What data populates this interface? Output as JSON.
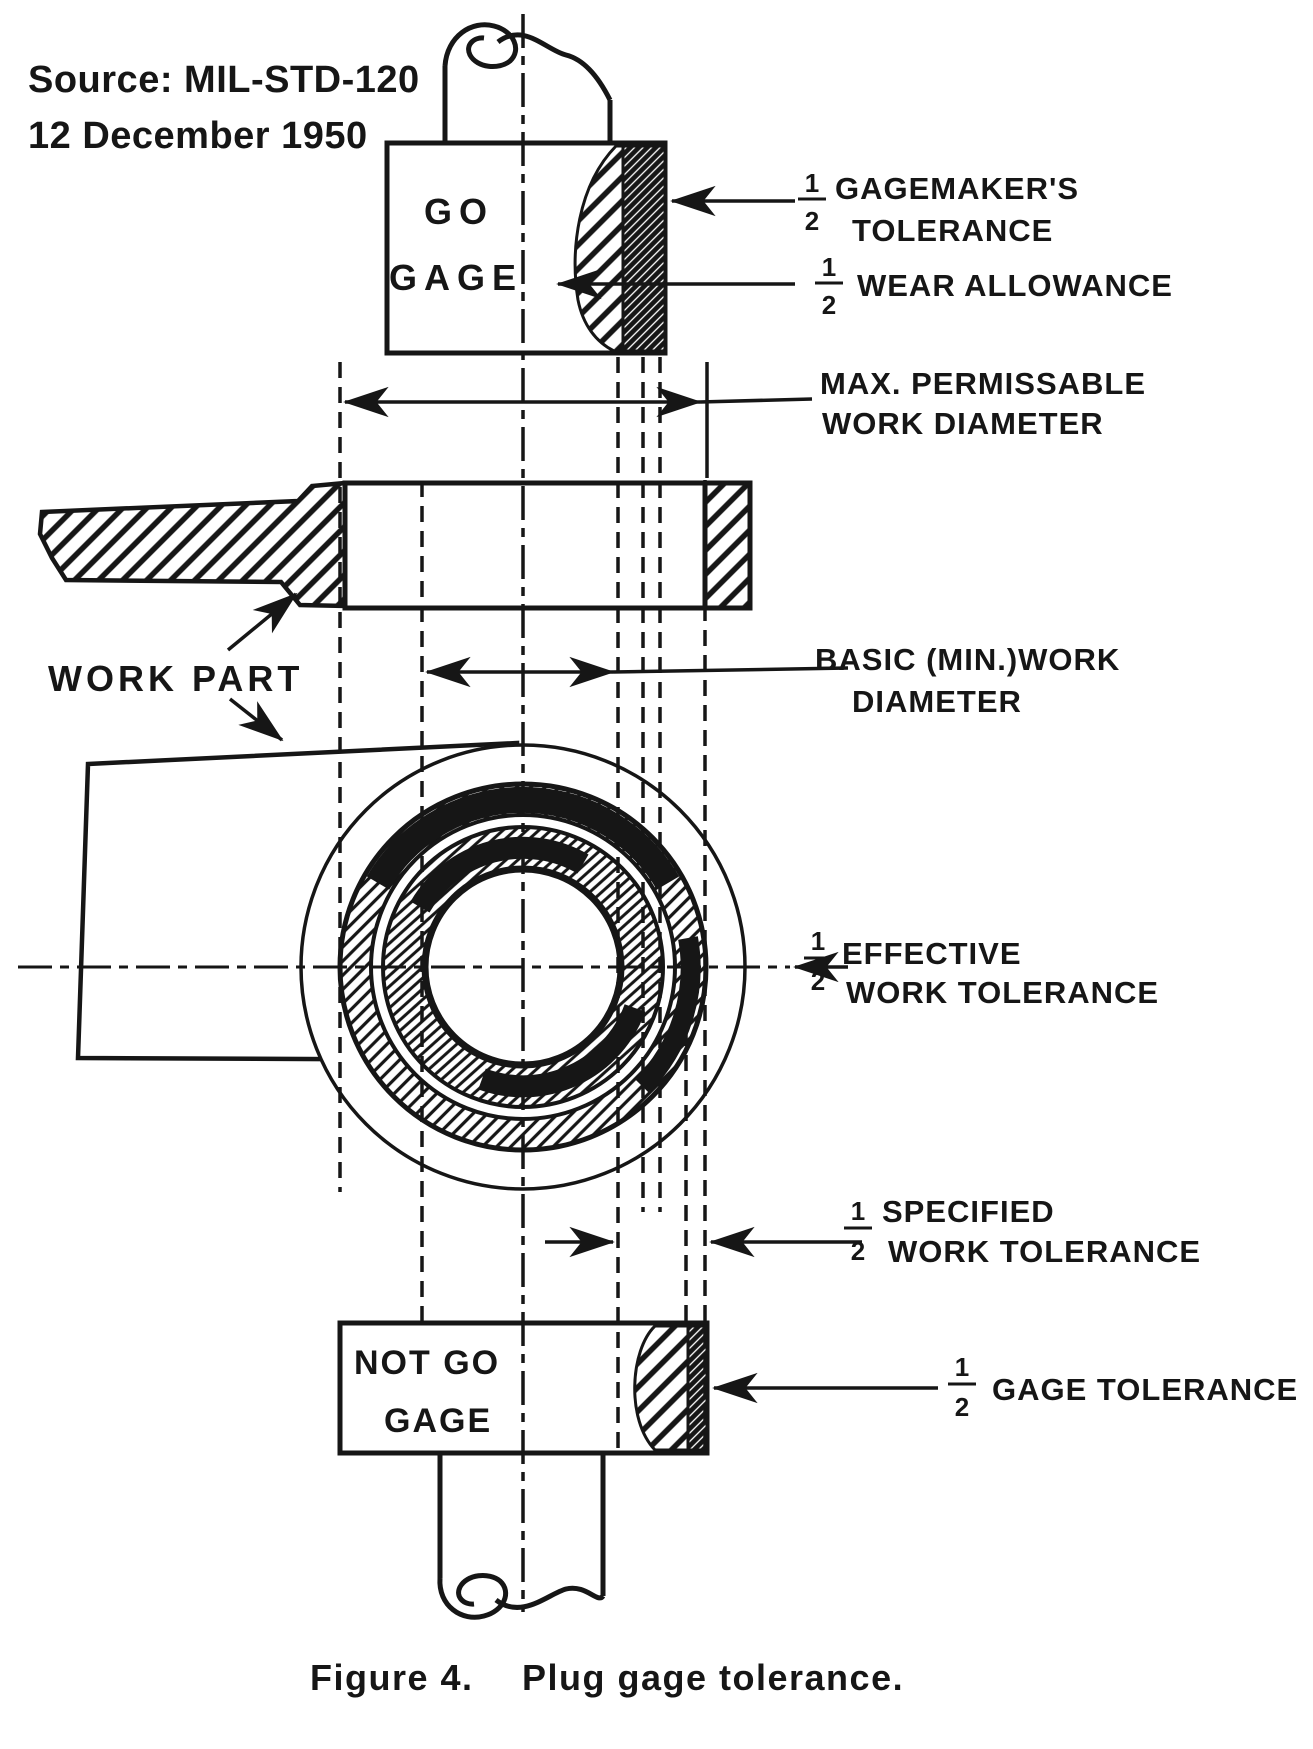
{
  "colors": {
    "ink": "#161616",
    "paper": "#ffffff"
  },
  "header": {
    "source_line1": "Source: MIL-STD-120",
    "source_line2": "12 December 1950"
  },
  "gages": {
    "go": {
      "line1": "GO",
      "line2": "GAGE"
    },
    "not_go": {
      "line1": "NOT GO",
      "line2": "GAGE"
    }
  },
  "fraction": {
    "num": "1",
    "den": "2"
  },
  "annotations": {
    "gagemakers_tolerance": {
      "line1": "GAGEMAKER'S",
      "line2": "TOLERANCE"
    },
    "wear_allowance": "WEAR ALLOWANCE",
    "max_permissible": {
      "line1": "MAX. PERMISSABLE",
      "line2": "WORK DIAMETER"
    },
    "basic_work_diameter": {
      "line1": "BASIC (MIN.)WORK",
      "line2": "DIAMETER"
    },
    "work_part": "WORK PART",
    "effective_work_tolerance": {
      "line1": "EFFECTIVE",
      "line2": "WORK TOLERANCE"
    },
    "specified_work_tolerance": {
      "line1": "SPECIFIED",
      "line2": "WORK TOLERANCE"
    },
    "gage_tolerance": "GAGE TOLERANCE"
  },
  "caption": {
    "figure_label": "Figure 4.",
    "figure_title": "Plug gage tolerance."
  }
}
